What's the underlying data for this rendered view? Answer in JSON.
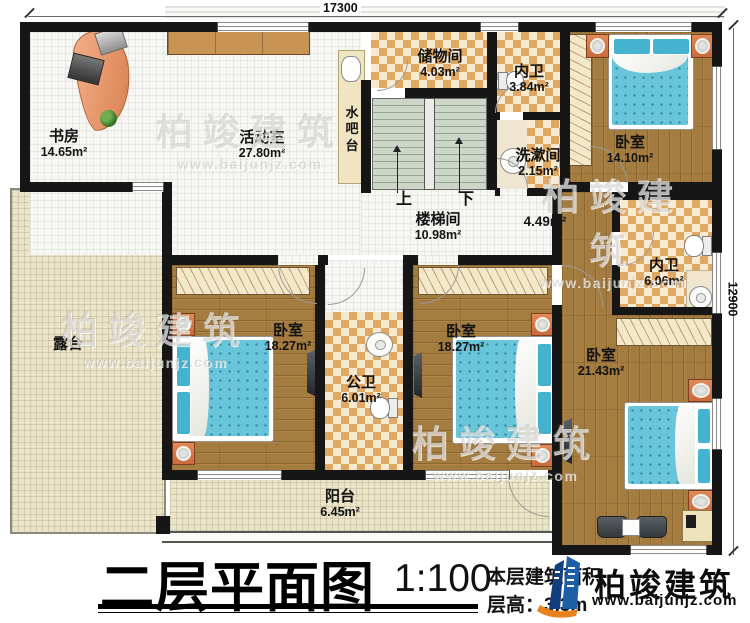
{
  "dimensions": {
    "width_mm": "17300",
    "height_mm": "12900"
  },
  "rooms": {
    "study": {
      "name": "书房",
      "area": "14.65m²"
    },
    "activity": {
      "name": "活动室",
      "area": "27.80m²"
    },
    "water_bar": {
      "name": "水吧台"
    },
    "storage": {
      "name": "储物间",
      "area": "4.03m²"
    },
    "bath_top": {
      "name": "内卫",
      "area": "3.84m²"
    },
    "washroom": {
      "name": "洗漱间",
      "area": "2.15m²"
    },
    "bedroom_top_right": {
      "name": "卧室",
      "area": "14.10m²"
    },
    "stairwell": {
      "name": "楼梯间",
      "area": "10.98m²"
    },
    "hallway": {
      "area": "4.49m²"
    },
    "bath_right": {
      "name": "内卫",
      "area": "6.06m²"
    },
    "terrace": {
      "name": "露台"
    },
    "bedroom_bottom_left": {
      "name": "卧室",
      "area": "18.27m²"
    },
    "public_bath": {
      "name": "公卫",
      "area": "6.01m²"
    },
    "bedroom_bottom_middle": {
      "name": "卧室",
      "area": "18.27m²"
    },
    "bedroom_bottom_right": {
      "name": "卧室",
      "area": "21.43m²"
    },
    "balcony": {
      "name": "阳台",
      "area": "6.45m²"
    }
  },
  "stairs": {
    "up": "上",
    "down": "下"
  },
  "title": {
    "text": "二层平面图",
    "scale": "1:100"
  },
  "notes": {
    "floor_area_label": "本层建筑面积",
    "floor_height": "层高：3.3m"
  },
  "brand": {
    "name": "柏竣建筑",
    "url": "www.baijunjz.com"
  },
  "watermark": {
    "name": "柏竣建筑",
    "url": "www.baijunjz.com"
  },
  "colors": {
    "wall": "#161616",
    "wood": "#a57c40",
    "checker_tan": "#dfa964",
    "bed_teal": "#68c5da",
    "brand_blue": "#1d5fa6",
    "brand_orange": "#e8821e"
  }
}
